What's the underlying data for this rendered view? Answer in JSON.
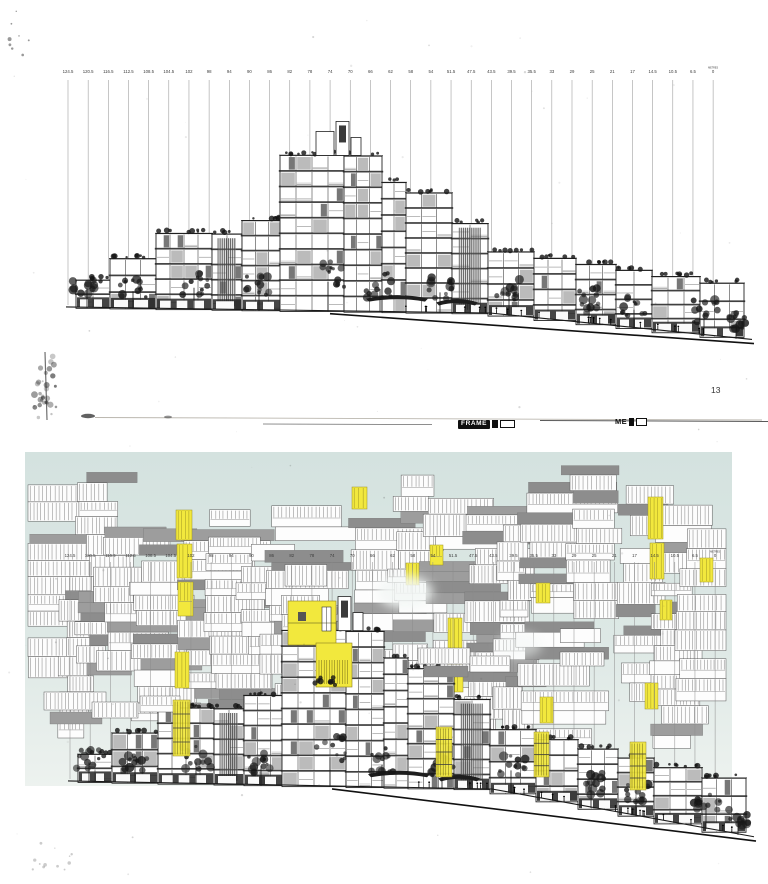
{
  "labels": {
    "frame": "FRAME",
    "me": "ME",
    "sheet_number": "13",
    "metres": "METRES",
    "zero": "0"
  },
  "scale_labels": [
    "124.5",
    "120.5",
    "116.5",
    "112.5",
    "108.5",
    "104.5",
    "102",
    "98",
    "94",
    "90",
    "86",
    "82",
    "78",
    "74",
    "70",
    "66",
    "62",
    "58",
    "54",
    "51.5",
    "47.5",
    "43.5",
    "39.5",
    "35.5",
    "33",
    "29",
    "25",
    "21",
    "17",
    "14.5",
    "10.5",
    "6.5"
  ],
  "colors": {
    "paper": "#ffffff",
    "panel_top": "#d4e2df",
    "panel_mid": "#dde8e5",
    "panel_bottom": "#edf2ef",
    "ink": "#1f1f1f",
    "grid_line": "#8c8c8c",
    "label_text": "#3c3c3c",
    "module_gray": "#8d8d8d",
    "module_stroke": "#585858",
    "highlight_yellow": "#f2e83d",
    "highlight_stroke": "#9a8f24"
  }
}
